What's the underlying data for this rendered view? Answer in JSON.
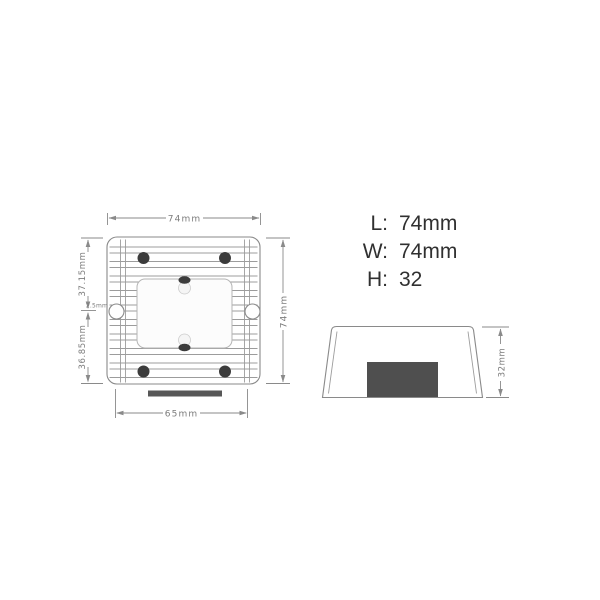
{
  "colors": {
    "line": "#8a8a8a",
    "fin": "#9c9c9c",
    "screw": "#3c3c3c",
    "connector": "#4f4f4f",
    "dim": "#7c7c7c",
    "spec": "#303030",
    "label-border": "#b5b5b5",
    "bg": "#ffffff"
  },
  "top_view": {
    "width_dim": "74mm",
    "height_dim": "74mm",
    "base_dim": "65mm",
    "upper_left_dim": "37.15mm",
    "lower_left_dim": "36.85mm",
    "hole_dim": "2.5mm"
  },
  "side_view": {
    "height_dim": "32mm"
  },
  "specs": {
    "rows": [
      {
        "label": "L:",
        "value": "74mm"
      },
      {
        "label": "W:",
        "value": "74mm"
      },
      {
        "label": "H:",
        "value": "32"
      }
    ]
  }
}
